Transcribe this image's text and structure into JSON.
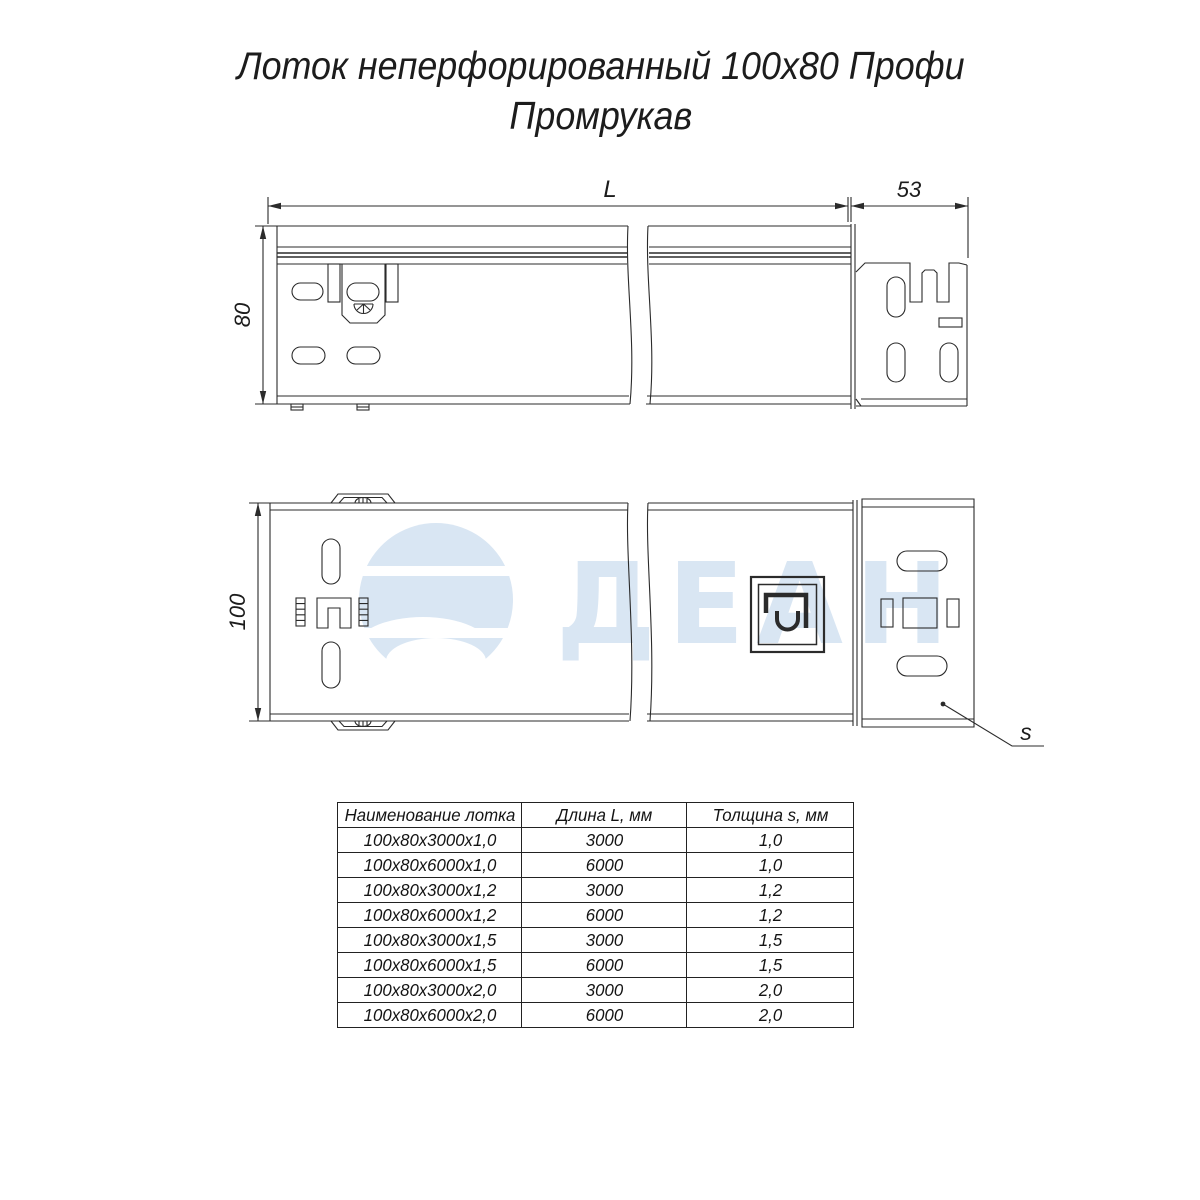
{
  "title": {
    "line1": "Лоток неперфорированный 100х80 Профи",
    "line2": "Промрукав"
  },
  "drawing": {
    "dim_length_label": "L",
    "dim_end_width_label": "53",
    "dim_height_label": "80",
    "dim_width_label": "100",
    "dim_thickness_label": "s"
  },
  "watermark": {
    "text": "ДЕАН",
    "color": "#d9e6f3"
  },
  "colors": {
    "line": "#2b2b2b",
    "text": "#1c1c1c"
  },
  "table": {
    "headers": [
      "Наименование лотка",
      "Длина L, мм",
      "Толщина s, мм"
    ],
    "rows": [
      [
        "100х80х3000х1,0",
        "3000",
        "1,0"
      ],
      [
        "100х80х6000х1,0",
        "6000",
        "1,0"
      ],
      [
        "100х80х3000х1,2",
        "3000",
        "1,2"
      ],
      [
        "100х80х6000х1,2",
        "6000",
        "1,2"
      ],
      [
        "100х80х3000х1,5",
        "3000",
        "1,5"
      ],
      [
        "100х80х6000х1,5",
        "6000",
        "1,5"
      ],
      [
        "100х80х3000х2,0",
        "3000",
        "2,0"
      ],
      [
        "100х80х6000х2,0",
        "6000",
        "2,0"
      ]
    ]
  }
}
